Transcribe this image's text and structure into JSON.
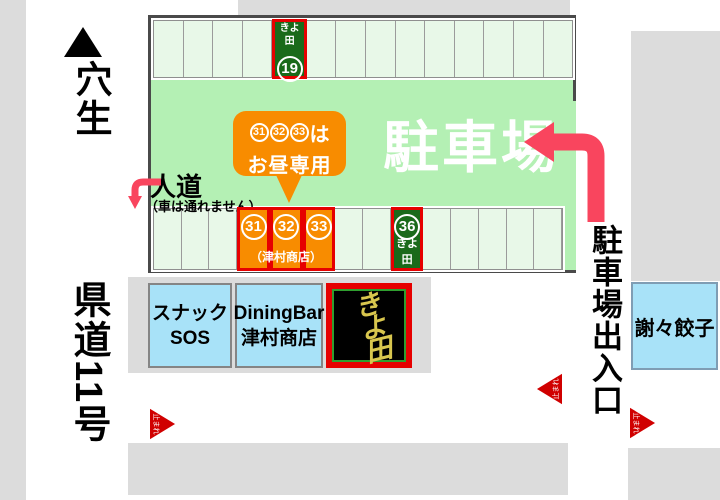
{
  "colors": {
    "road": "#dcdcdc",
    "parking_green": "#b4f0b4",
    "cell_bg": "#e8f8e8",
    "reserved_green": "#1a6a1a",
    "highlight_red": "#e60000",
    "lunch_orange": "#f88c00",
    "arrow_pink": "#f9455e",
    "building_blue": "#a8e2f8",
    "sign_gold": "#d8c64e",
    "stop_red": "#d00000"
  },
  "top_left": {
    "direction_label": "穴生"
  },
  "left_road_label": "県道11号",
  "parking": {
    "title": "駐車場",
    "walkway_label": "人道",
    "walkway_note": "（車は通れません）",
    "bubble": {
      "numbers": [
        "31",
        "32",
        "33"
      ],
      "suffix": "は",
      "line2": "お昼専用"
    },
    "top_row": {
      "cells": 14,
      "reserved": {
        "index": 4,
        "number": "19",
        "label": "きよ田"
      }
    },
    "bottom_row": {
      "cells": 14,
      "lunch": {
        "indices": [
          3,
          4,
          5
        ],
        "numbers": [
          "31",
          "32",
          "33"
        ],
        "caption": "（津村商店）"
      },
      "reserved": {
        "index": 8,
        "number": "36",
        "label": "きよ田"
      }
    }
  },
  "entrance_label": "駐車場出入口",
  "buildings": {
    "snack": {
      "line1": "スナック",
      "line2": "SOS"
    },
    "dining": {
      "line1": "DiningBar",
      "line2": "津村商店"
    },
    "kiyota": {
      "name": "きよ田"
    },
    "gyoza": {
      "name": "謝々餃子"
    }
  },
  "stop_markers": {
    "text": "止まれ"
  }
}
